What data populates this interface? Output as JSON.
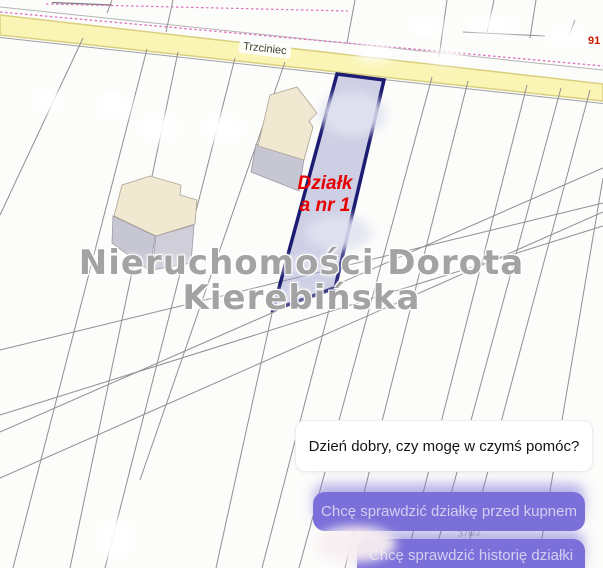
{
  "map": {
    "road": {
      "label": "Trzciniec"
    },
    "corner_parcel_number": "91",
    "faint_parcel_number": "378/2",
    "highlighted_parcel": {
      "label_line1": "Działk",
      "label_line2": "a nr 1"
    },
    "colors": {
      "road_fill": "#faf5b5",
      "road_edge": "#d9cf7f",
      "boundary_line": "#8f8f8f",
      "centerline_pink": "#dd6fc0",
      "parcel_fill": "#8f92c8",
      "parcel_border": "#1c1c72",
      "building_roof": "#f0e8d0",
      "building_side": "#c7c6d3",
      "annotation_red": "#e80000"
    }
  },
  "watermark": {
    "line1": "Nieruchomości Dorota",
    "line2": "Kierebińska"
  },
  "chat": {
    "agent_message": "Dzień dobry, czy mogę w czymś pomóc?",
    "accent_color": "#7b70d9",
    "quick_replies": [
      {
        "label": "Chcę sprawdzić działkę przed kupnem"
      },
      {
        "label": "Chcę sprawdzić historię działki"
      }
    ]
  }
}
